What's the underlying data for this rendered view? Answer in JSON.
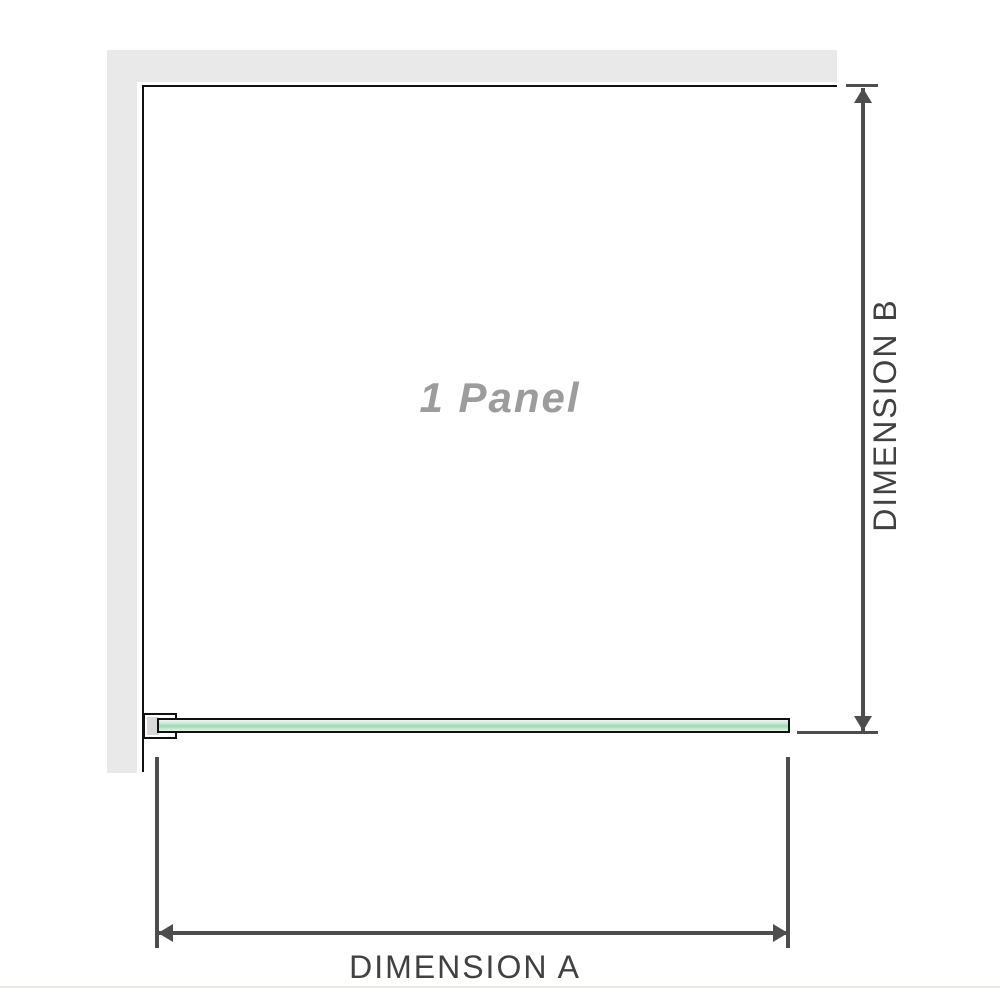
{
  "figure": {
    "type": "shower-screen-dimension-diagram",
    "panel_label": "1 Panel",
    "dimension_a": {
      "label": "DIMENSION A"
    },
    "dimension_b": {
      "label": "DIMENSION B"
    },
    "colors": {
      "wall_fill": "#e9e9e9",
      "wall_edge": "#111111",
      "dimension_line": "#4d4d4d",
      "dimension_text": "#414141",
      "panel_label_text": "#9c9c9c",
      "glass_fill": "#9fd6b6",
      "glass_border": "#111111",
      "bracket_fill": "#d9d9d9",
      "divider": "#e9e9e5"
    }
  }
}
